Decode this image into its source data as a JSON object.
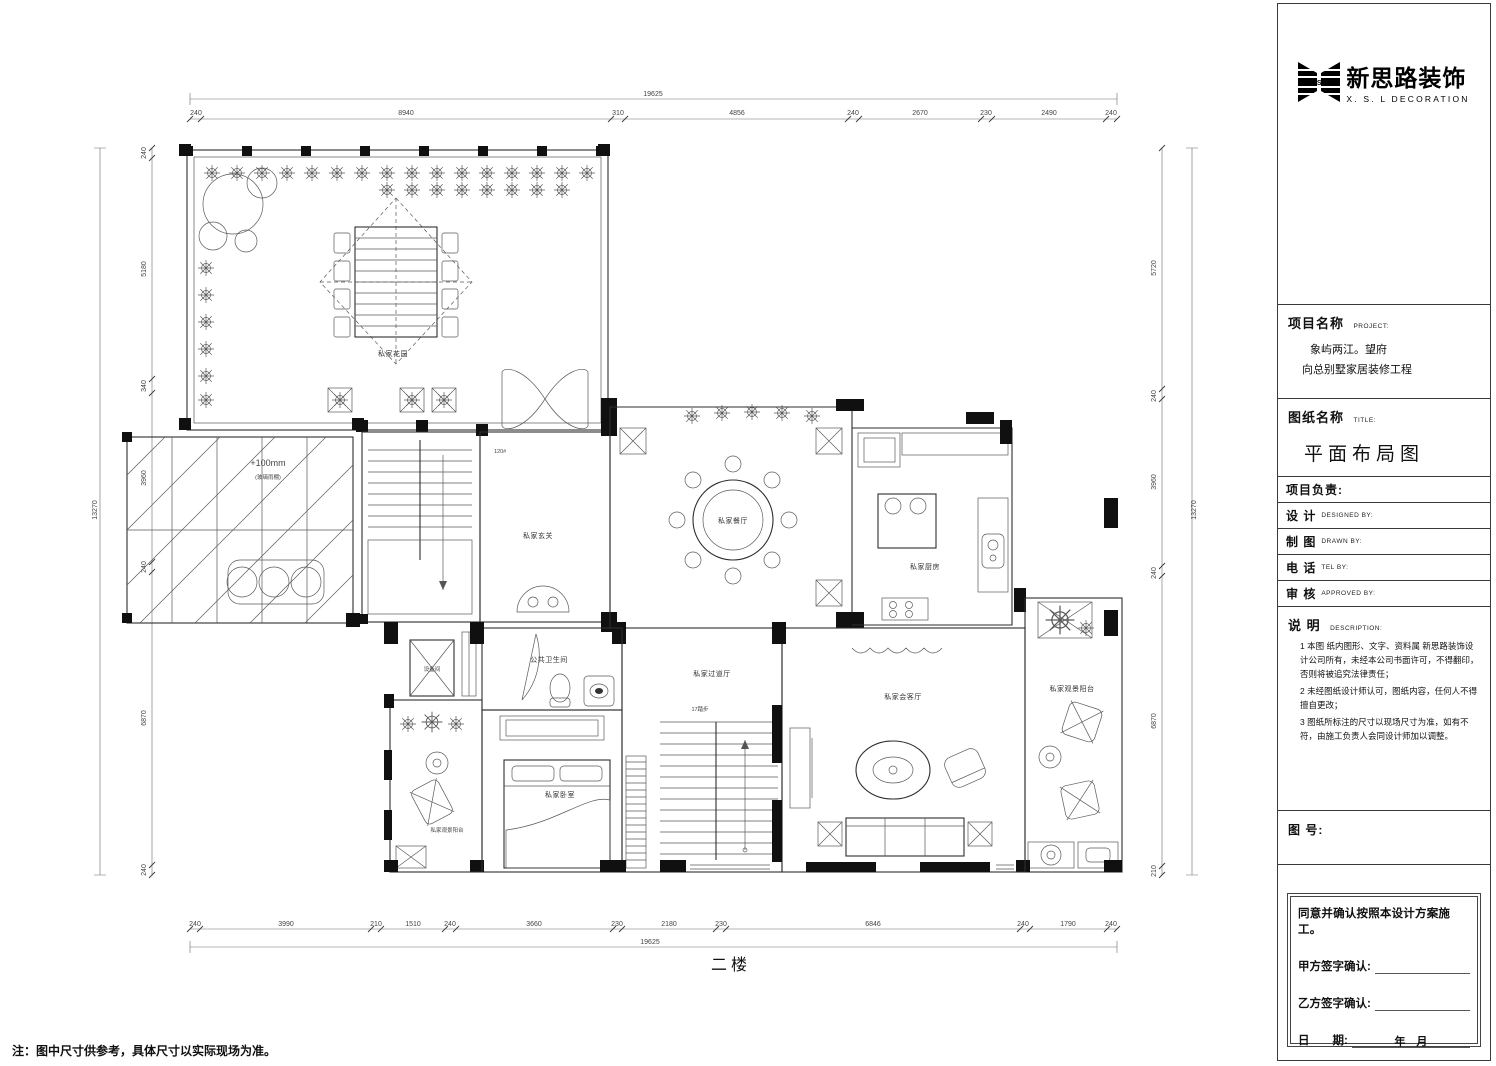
{
  "page": {
    "floor_label": "二楼",
    "note": "注：图中尺寸供参考，具体尺寸以实际现场为准。"
  },
  "logo": {
    "mark": "X.S.L",
    "brand_cn": "新思路装饰",
    "brand_en": "X. S. L  DECORATION"
  },
  "title_block": {
    "project_label": "项目名称",
    "project_label_en": "PROJECT:",
    "project_line1": "象屿两江。望府",
    "project_line2": "向总别墅家居装修工程",
    "drawing_label": "图纸名称",
    "drawing_label_en": "TITLE:",
    "drawing_title": "平面布局图",
    "leader_label": "项目负责:",
    "fields": [
      {
        "cn": "设  计",
        "en": "DESIGNED BY:"
      },
      {
        "cn": "制  图",
        "en": "DRAWN BY:"
      },
      {
        "cn": "电  话",
        "en": "TEL BY:"
      },
      {
        "cn": "审  核",
        "en": "APPROVED BY:"
      }
    ],
    "desc_label": "说  明",
    "desc_label_en": "DESCRIPTION:",
    "desc_items": [
      "1 本图 纸内图形、文字、资料属 新思路装饰设计公司所有，未经本公司书面许可，不得翻印，否则将被追究法律责任；",
      "2 未经图纸设计师认可，图纸内容，任何人不得擅自更改；",
      "3 图纸所标注的尺寸以现场尺寸为准，如有不符，由施工负责人会同设计师加以调整。"
    ],
    "number_label": "图  号:",
    "sig_statement": "同意并确认按照本设计方案施工。",
    "sig_party_a": "甲方签字确认:",
    "sig_party_b": "乙方签字确认:",
    "sig_date_label": "日　　期:",
    "sig_date_value": "年　月"
  },
  "rooms": {
    "garden": "私家花园",
    "foyer": "私家玄关",
    "dining": "私家餐厅",
    "kitchen": "私家厨房",
    "equipment": "设备间",
    "bathroom": "公共卫生间",
    "corridor": "私家过道厅",
    "living": "私家会客厅",
    "bedroom": "私家卧室",
    "balcony_left": "私家观景阳台",
    "balcony_right": "私家观景阳台"
  },
  "annotations": {
    "canopy_level": "+100mm",
    "canopy_note": "(玻璃雨棚)",
    "stair_steps": "17踏步",
    "door_mark": "120#"
  },
  "dims": {
    "top": [
      "240",
      "8940",
      "310",
      "4856",
      "240",
      "2670",
      "230",
      "2490",
      "240"
    ],
    "top_overall": "19625",
    "bottom": [
      "240",
      "3990",
      "210",
      "1510",
      "240",
      "3660",
      "230",
      "2180",
      "230",
      "6846",
      "240",
      "1790",
      "240"
    ],
    "bottom_overall": "19625",
    "left": [
      "240",
      "5180",
      "340",
      "3960",
      "240",
      "6870",
      "240"
    ],
    "left_overall": "13270",
    "right": [
      "5720",
      "240",
      "3960",
      "240",
      "6870",
      "210"
    ],
    "right_overall": "13270"
  }
}
